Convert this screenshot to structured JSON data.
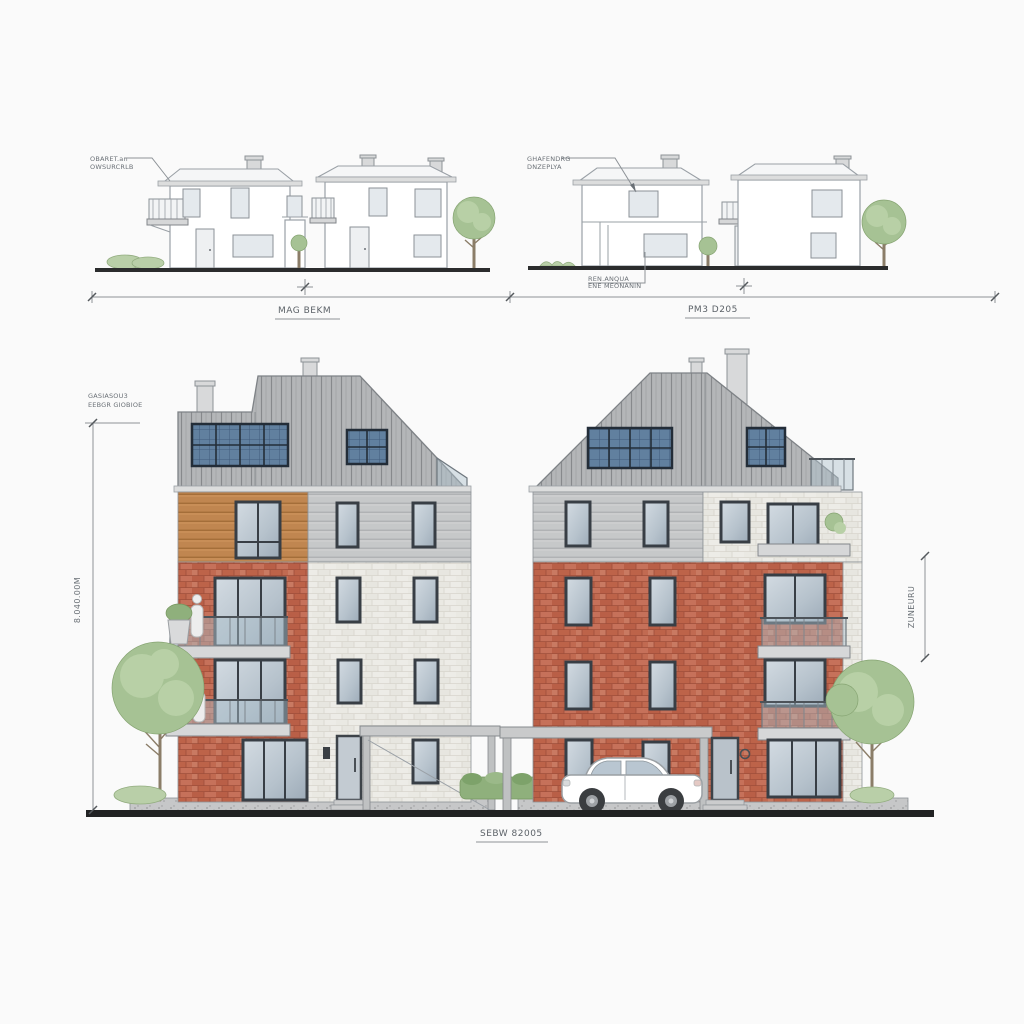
{
  "annotations": {
    "upper_left_note_line1": "OBARET.an",
    "upper_left_note_line2": "OWSURCRLB",
    "upper_left_label": "MAG BEKM",
    "upper_right_note_line1": "GHAFENDRG",
    "upper_right_note_line2": "DNZEPLYA",
    "upper_right_subnote_line1": "REN.ANQUA",
    "upper_right_subnote_line2": "ENE MEONANIN",
    "upper_right_label": "PM3 D205",
    "main_left_note_line1": "GASIASOU3",
    "main_left_note_line2": "EEBGR GIOBIOE",
    "main_left_dim_vertical": "8.040.00M",
    "main_right_dim_vertical": "ZUNEURU",
    "main_label": "SEBW 82005"
  },
  "colors": {
    "background": "#fafafa",
    "line_work": "#9aa0a6",
    "roof_gray": "#b4b6b8",
    "roof_stripe": "#87898c",
    "solar_panel_blue": "#61809f",
    "solar_frame": "#232d38",
    "brick_red": "#c16a51",
    "brick_white": "#edece7",
    "siding_gray": "#c6c8c9",
    "wood_cladding": "#c08650",
    "window_frame": "#383e45",
    "glass": "#b6c2cc",
    "tree_green": "#a6c294",
    "ground_black": "#212223"
  }
}
